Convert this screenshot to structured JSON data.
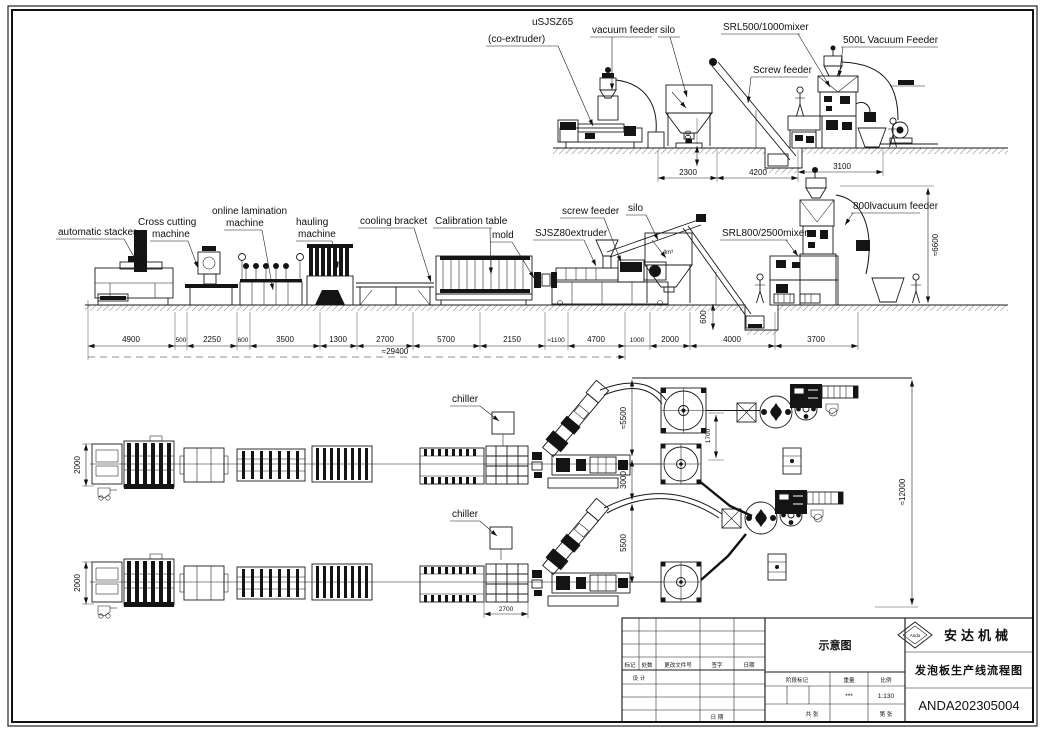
{
  "top_view": {
    "labels": {
      "co_extruder_model": "uSJSZ65",
      "co_extruder_name": "(co-extruder)",
      "vacuum_feeder": "vacuum feeder",
      "silo": "silo",
      "mixer": "SRL500/1000mixer",
      "screw_feeder": "Screw feeder",
      "vacuum_feeder_500l": "500L Vacuum Feeder"
    },
    "dims": {
      "silo_span": "2300",
      "feeder_span": "4200",
      "mixer_span": "3100",
      "pit_depth": "600"
    }
  },
  "side_view": {
    "labels": {
      "automatic_stacker": "automatic stacker",
      "cross_cutting_l1": "Cross cutting",
      "cross_cutting_l2": "machine",
      "lamination_l1": "online lamination",
      "lamination_l2": "machine",
      "hauling_l1": "hauling",
      "hauling_l2": "machine",
      "cooling_bracket": "cooling bracket",
      "calibration_table": "Calibration table",
      "mold": "mold",
      "extruder": "SJSZ80extruder",
      "screw_feeder": "screw feeder",
      "silo": "silo",
      "silo_volume": "4m³",
      "mixer": "SRL800/2500mixer",
      "vacuum_feeder": "800lvacuum feeder"
    },
    "dims": {
      "chain": [
        "4900",
        "500",
        "2250",
        "600",
        "3500",
        "1300",
        "2700",
        "5700",
        "2150",
        "≈1100",
        "4700",
        "1000",
        "2000",
        "4000",
        "3700"
      ],
      "total": "≈29400",
      "line_height": "≈6600",
      "pit_depth": "600"
    }
  },
  "plan_view": {
    "labels": {
      "chiller_top": "chiller",
      "chiller_bottom": "chiller"
    },
    "dims": {
      "line1_width": "2000",
      "line2_width": "2000",
      "offset_top": "≈5500",
      "offset_mid": "3000",
      "offset_bottom": "5500",
      "silo_offset": "1700",
      "overall_depth": "≈12000",
      "tank_length": "2700"
    }
  },
  "title_block": {
    "view_name": "示意图",
    "company": "安达机械",
    "logo_text": "Anda",
    "drawing_title": "发泡板生产线流程图",
    "drawing_no": "ANDA202305004",
    "rev_cols": [
      "标记",
      "处数",
      "更改文件号",
      "签字",
      "日期"
    ],
    "design_label": "设 计",
    "date_label": "日 期",
    "stage_label": "阶段标记",
    "weight_label": "重量",
    "scale_label": "比例",
    "weight_value": "***",
    "scale_value": "1:130",
    "sheet_total": "共 张",
    "sheet_index": "第 张"
  }
}
